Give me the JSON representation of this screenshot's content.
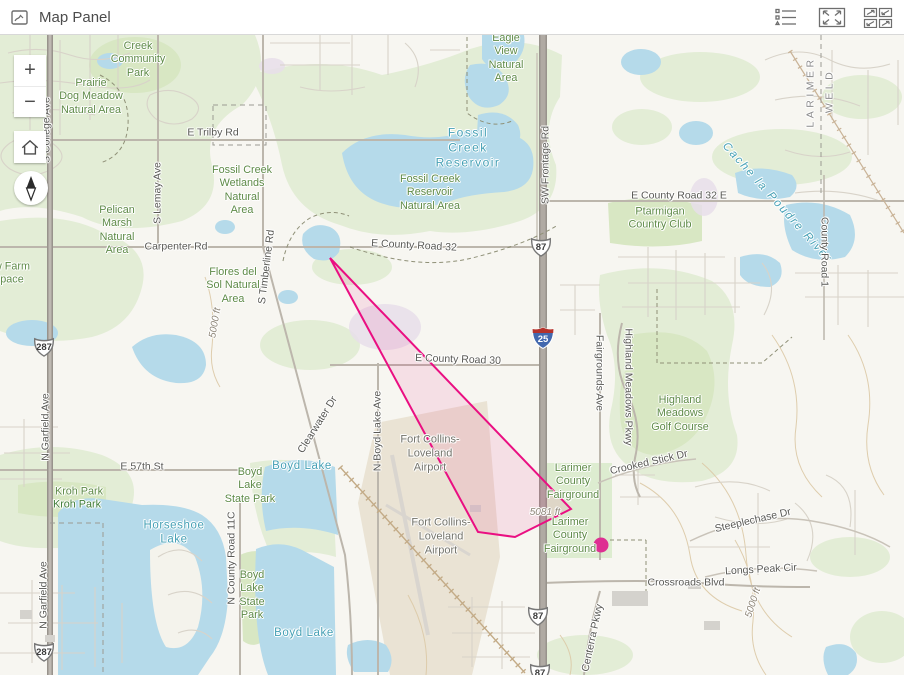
{
  "header": {
    "title": "Map Panel",
    "buttons": [
      {
        "name": "legend-button"
      },
      {
        "name": "expand-button"
      },
      {
        "name": "switch-panel-button"
      }
    ]
  },
  "controls": {
    "zoom_in": "+",
    "zoom_out": "−"
  },
  "colors": {
    "highlight_stroke": "#ea0f82",
    "highlight_fill": "rgba(234,15,130,0.10)",
    "point_fill": "#de2f92",
    "water": "#b5daea",
    "vegetation": "#e3edd6",
    "park": "#d8e7c3"
  },
  "map": {
    "labels": [
      {
        "text": "Creek\nCommunity\nPark",
        "x": 138,
        "y": 25,
        "type": "park"
      },
      {
        "text": "Prairie\nDog Meadow\nNatural Area",
        "x": 91,
        "y": 62,
        "type": "park"
      },
      {
        "text": "E Trilby Rd",
        "x": 213,
        "y": 98,
        "type": "road"
      },
      {
        "text": "Eagle\nView\nNatural\nArea",
        "x": 506,
        "y": 24,
        "type": "park"
      },
      {
        "text": "Fossil\nCreek\nReservoir",
        "x": 468,
        "y": 113,
        "type": "water",
        "size": 12,
        "spacing": 1.5
      },
      {
        "text": "Fossil Creek\nWetlands\nNatural\nArea",
        "x": 242,
        "y": 156,
        "type": "park"
      },
      {
        "text": "Fossil Creek\nReservoir\nNatural Area",
        "x": 430,
        "y": 158,
        "type": "park"
      },
      {
        "text": "E County Road 32",
        "x": 414,
        "y": 211,
        "type": "road",
        "rotate": 3
      },
      {
        "text": "SW Frontage Rd",
        "x": 546,
        "y": 130,
        "type": "road",
        "rotate": -90
      },
      {
        "text": "Pelican\nMarsh\nNatural\nArea",
        "x": 117,
        "y": 196,
        "type": "park"
      },
      {
        "text": "Carpenter Rd",
        "x": 176,
        "y": 212,
        "type": "road"
      },
      {
        "text": "S Lemay Ave",
        "x": 158,
        "y": 158,
        "type": "road",
        "rotate": -90
      },
      {
        "text": "S Timberline Rd",
        "x": 267,
        "y": 232,
        "type": "road",
        "rotate": -83
      },
      {
        "text": "Flores del\nSol Natural\nArea",
        "x": 233,
        "y": 251,
        "type": "park"
      },
      {
        "text": "w Farm\npace",
        "x": 12,
        "y": 239,
        "type": "park"
      },
      {
        "text": "E County Road 32 E",
        "x": 679,
        "y": 161,
        "type": "road"
      },
      {
        "text": "Ptarmigan\nCountry Club",
        "x": 660,
        "y": 184,
        "type": "park"
      },
      {
        "text": "Cache la Poudre River",
        "x": 777,
        "y": 168,
        "type": "water",
        "rotate": 48,
        "spacing": 2,
        "italic": true
      },
      {
        "text": "County Road 1",
        "x": 824,
        "y": 217,
        "type": "road",
        "rotate": 90
      },
      {
        "text": "LARIMER",
        "x": 811,
        "y": 57,
        "type": "county",
        "rotate": -90
      },
      {
        "text": "WELD",
        "x": 830,
        "y": 56,
        "type": "county",
        "rotate": -90
      },
      {
        "text": "S College Ave",
        "x": 47,
        "y": 95,
        "type": "road",
        "rotate": -90
      },
      {
        "text": "5000 ft",
        "x": 216,
        "y": 288,
        "type": "elev",
        "rotate": -80
      },
      {
        "text": "E County Road 30",
        "x": 458,
        "y": 325,
        "type": "road",
        "rotate": 2
      },
      {
        "text": "N Boyd Lake Ave",
        "x": 378,
        "y": 396,
        "type": "road",
        "rotate": -90
      },
      {
        "text": "Clearwater Dr",
        "x": 318,
        "y": 390,
        "type": "road",
        "rotate": -58
      },
      {
        "text": "Fairgrounds Ave",
        "x": 599,
        "y": 338,
        "type": "road",
        "rotate": 90
      },
      {
        "text": "Highland Meadows Pkwy",
        "x": 628,
        "y": 352,
        "type": "road",
        "rotate": 90
      },
      {
        "text": "Highland\nMeadows\nGolf Course",
        "x": 680,
        "y": 379,
        "type": "park"
      },
      {
        "text": "Crooked Stick Dr",
        "x": 649,
        "y": 428,
        "type": "road",
        "rotate": -13
      },
      {
        "text": "Larimer\nCounty\nFairground",
        "x": 573,
        "y": 447,
        "type": "park"
      },
      {
        "text": "Larimer\nCounty\nFairground",
        "x": 570,
        "y": 501,
        "type": "park"
      },
      {
        "text": "5081 ft",
        "x": 545,
        "y": 478,
        "type": "elev"
      },
      {
        "text": "Fort Collins-\nLoveland\nAirport",
        "x": 430,
        "y": 419,
        "type": "airport"
      },
      {
        "text": "Fort Collins-\nLoveland\nAirport",
        "x": 441,
        "y": 502,
        "type": "airport"
      },
      {
        "text": "E 57th St",
        "x": 142,
        "y": 432,
        "type": "road"
      },
      {
        "text": "Boyd Lake",
        "x": 302,
        "y": 431,
        "type": "water"
      },
      {
        "text": "Boyd\nLake\nState Park",
        "x": 250,
        "y": 451,
        "type": "park"
      },
      {
        "text": "Kroh Park",
        "x": 79,
        "y": 457,
        "type": "park"
      },
      {
        "text": "Kroh Park",
        "x": 77,
        "y": 470,
        "type": "parkdark"
      },
      {
        "text": "N Garfield Ave",
        "x": 46,
        "y": 392,
        "type": "road",
        "rotate": -90
      },
      {
        "text": "N Garfield Ave",
        "x": 44,
        "y": 560,
        "type": "road",
        "rotate": -90
      },
      {
        "text": "Horseshoe\nLake",
        "x": 174,
        "y": 498,
        "type": "water"
      },
      {
        "text": "N County Road 11C",
        "x": 232,
        "y": 523,
        "type": "road",
        "rotate": -90
      },
      {
        "text": "Boyd\nLake\nState\nPark",
        "x": 252,
        "y": 561,
        "type": "park"
      },
      {
        "text": "Boyd Lake",
        "x": 304,
        "y": 598,
        "type": "water"
      },
      {
        "text": "Steeplechase Dr",
        "x": 753,
        "y": 486,
        "type": "road",
        "rotate": -13
      },
      {
        "text": "Longs Peak Cir",
        "x": 761,
        "y": 535,
        "type": "road",
        "rotate": -3
      },
      {
        "text": "Crossroads Blvd",
        "x": 686,
        "y": 548,
        "type": "road"
      },
      {
        "text": "5000 ft",
        "x": 754,
        "y": 568,
        "type": "elev",
        "rotate": -72
      },
      {
        "text": "Centerra Pkwy",
        "x": 593,
        "y": 603,
        "type": "road",
        "rotate": -78
      }
    ],
    "shields": [
      {
        "kind": "us",
        "num": "287",
        "x": 44,
        "y": 312
      },
      {
        "kind": "us",
        "num": "287",
        "x": 44,
        "y": 617
      },
      {
        "kind": "us",
        "num": "87",
        "x": 541,
        "y": 212
      },
      {
        "kind": "interstate",
        "num": "25",
        "x": 543,
        "y": 303
      },
      {
        "kind": "us",
        "num": "87",
        "x": 538,
        "y": 581
      },
      {
        "kind": "us",
        "num": "87",
        "x": 540,
        "y": 638
      }
    ],
    "graphics": {
      "polygon": {
        "points": [
          [
            330,
            223
          ],
          [
            478,
            497
          ],
          [
            515,
            502
          ],
          [
            571,
            474
          ]
        ]
      },
      "point": {
        "x": 601,
        "y": 510,
        "r": 7.5
      }
    }
  }
}
